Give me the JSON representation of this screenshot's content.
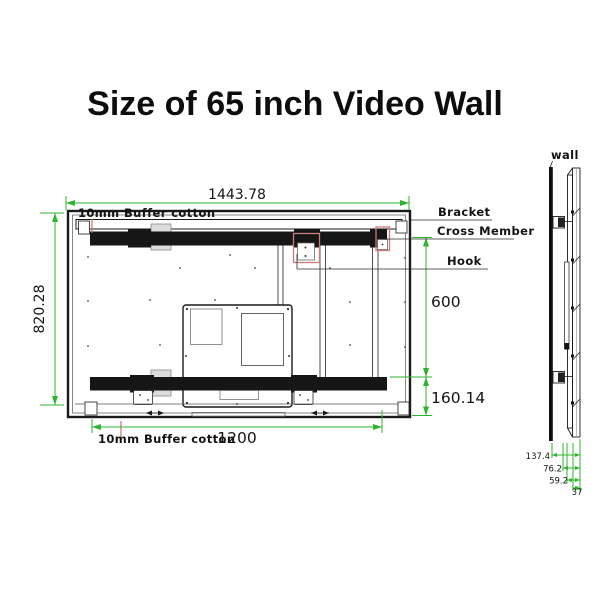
{
  "title": "Size of 65 inch Video Wall",
  "colors": {
    "dimension_green": "#2db52d",
    "leader_red": "#c86456",
    "hook_highlight": "#cc7a7a",
    "line_black": "#1a1a1a"
  },
  "front_view": {
    "dim_total_width": "1443.78",
    "dim_total_height": "820.28",
    "dim_cross_member_spacing": "600",
    "dim_bottom_offset": "160.14",
    "dim_hook_spacing": "1200",
    "label_buffer_top": "10mm Buffer cotton",
    "label_buffer_bottom": "10mm Buffer cotton",
    "label_bracket": "Bracket",
    "label_cross_member": "Cross Member",
    "label_hook": "Hook"
  },
  "side_view": {
    "label_wall": "wall",
    "dims": {
      "total_depth": "137.4",
      "mount_depth": "76.2",
      "bracket_depth": "59.2",
      "panel_depth": "37"
    }
  }
}
